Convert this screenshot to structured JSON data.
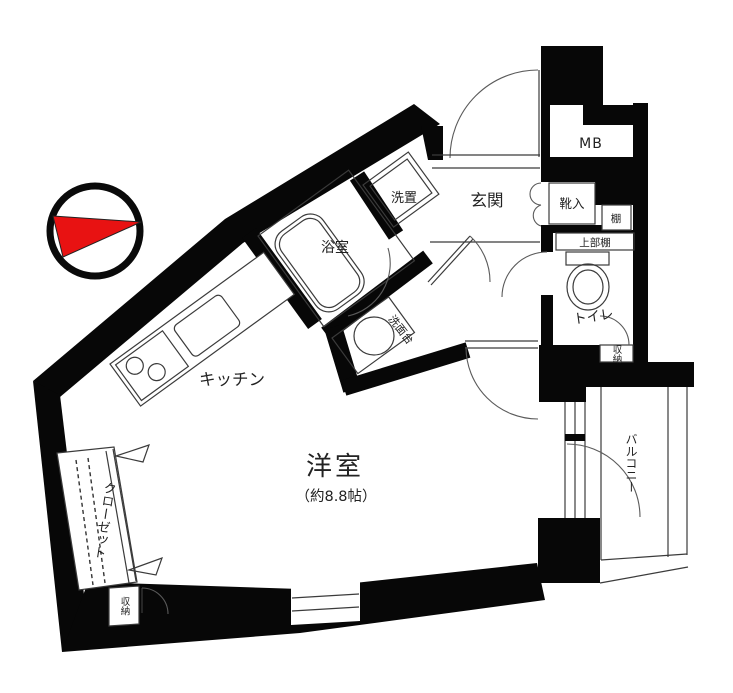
{
  "title": "間取り図",
  "labels": {
    "main_room": "洋室",
    "main_room_size": "（約8.8帖）",
    "kitchen": "キッチン",
    "bath": "浴室",
    "washer_space": "洗置",
    "vanity": "洗面台",
    "entrance": "玄関",
    "meter_box": "MB",
    "shoe_box": "靴入",
    "shelf": "棚",
    "upper_shelf": "上部棚",
    "toilet": "トイレ",
    "storage_toilet": "収納",
    "storage_entry": "収納",
    "closet": "クローゼット",
    "balcony": "バルコニー"
  },
  "compass": {
    "needle_color": "#e81212",
    "points": "right"
  },
  "colors": {
    "wall": "#070707",
    "thin_line": "#3b3b3b",
    "background": "#ffffff"
  }
}
